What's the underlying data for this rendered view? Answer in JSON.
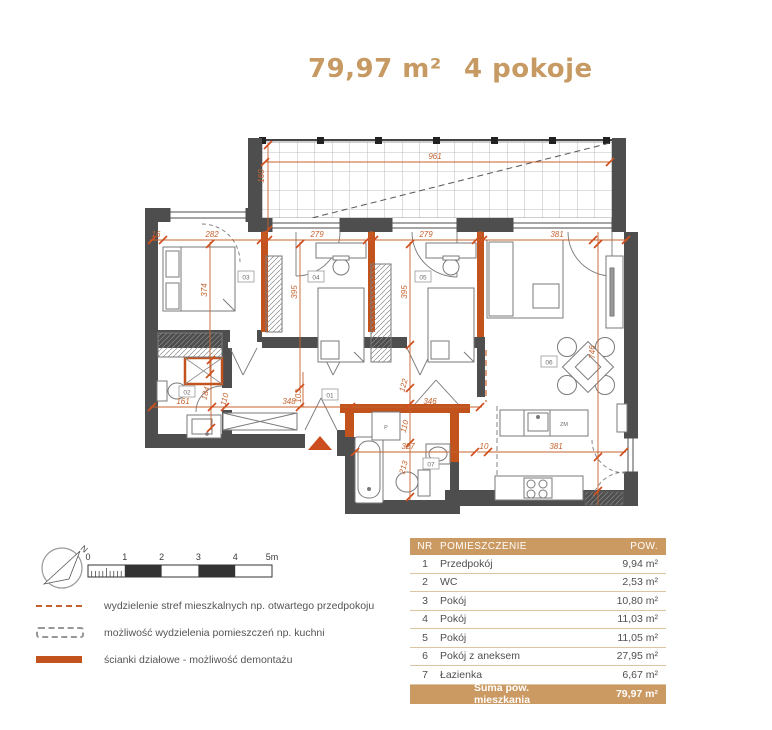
{
  "header": {
    "area": "79,97 m²",
    "rooms": "4 pokoje"
  },
  "colors": {
    "accent_tan": "#c69a62",
    "dimension_orange": "#c4632e",
    "partition_orange": "#c2531d",
    "wall_gray": "#4e4e4e",
    "table_header_bg": "#cb9962"
  },
  "plan": {
    "dims": {
      "w961": "961",
      "v160": "160",
      "d16": "16",
      "d282": "282",
      "d8a": "8",
      "d279a": "279",
      "d8b": "8",
      "d279b": "279",
      "d8c": "8",
      "d381a": "381",
      "v374": "374",
      "v395a": "395",
      "v395b": "395",
      "v746": "746",
      "d161": "161",
      "v184": "184",
      "v110a": "110",
      "d348": "348",
      "v103": "103",
      "v122": "122",
      "d346": "346",
      "v110b": "110",
      "d327": "327",
      "v213": "213",
      "d10": "10",
      "d381b": "381"
    },
    "rooms": {
      "r01": "01",
      "r02": "02",
      "r03": "03",
      "r04": "04",
      "r05": "05",
      "r06": "06",
      "r07": "07"
    },
    "labels": {
      "zm": "ZM",
      "p": "P"
    }
  },
  "compass": {
    "north": "N"
  },
  "scalebar": {
    "ticks": [
      "0",
      "1",
      "2",
      "3",
      "4",
      "5m"
    ]
  },
  "legend": {
    "items": [
      {
        "label": "wydzielenie stref mieszkalnych np. otwartego przedpokoju"
      },
      {
        "label": "możliwość wydzielenia pomieszczeń np. kuchni"
      },
      {
        "label": "ścianki działowe - możliwość demontażu"
      }
    ]
  },
  "table": {
    "headers": {
      "nr": "NR",
      "name": "POMIESZCZENIE",
      "area": "POW."
    },
    "rows": [
      {
        "nr": "1",
        "name": "Przedpokój",
        "area": "9,94 m²"
      },
      {
        "nr": "2",
        "name": "WC",
        "area": "2,53 m²"
      },
      {
        "nr": "3",
        "name": "Pokój",
        "area": "10,80 m²"
      },
      {
        "nr": "4",
        "name": "Pokój",
        "area": "11,03 m²"
      },
      {
        "nr": "5",
        "name": "Pokój",
        "area": "11,05 m²"
      },
      {
        "nr": "6",
        "name": "Pokój z aneksem",
        "area": "27,95 m²"
      },
      {
        "nr": "7",
        "name": "Łazienka",
        "area": "6,67 m²"
      }
    ],
    "footer": {
      "label": "Suma pow. mieszkania",
      "value": "79,97 m²"
    }
  }
}
